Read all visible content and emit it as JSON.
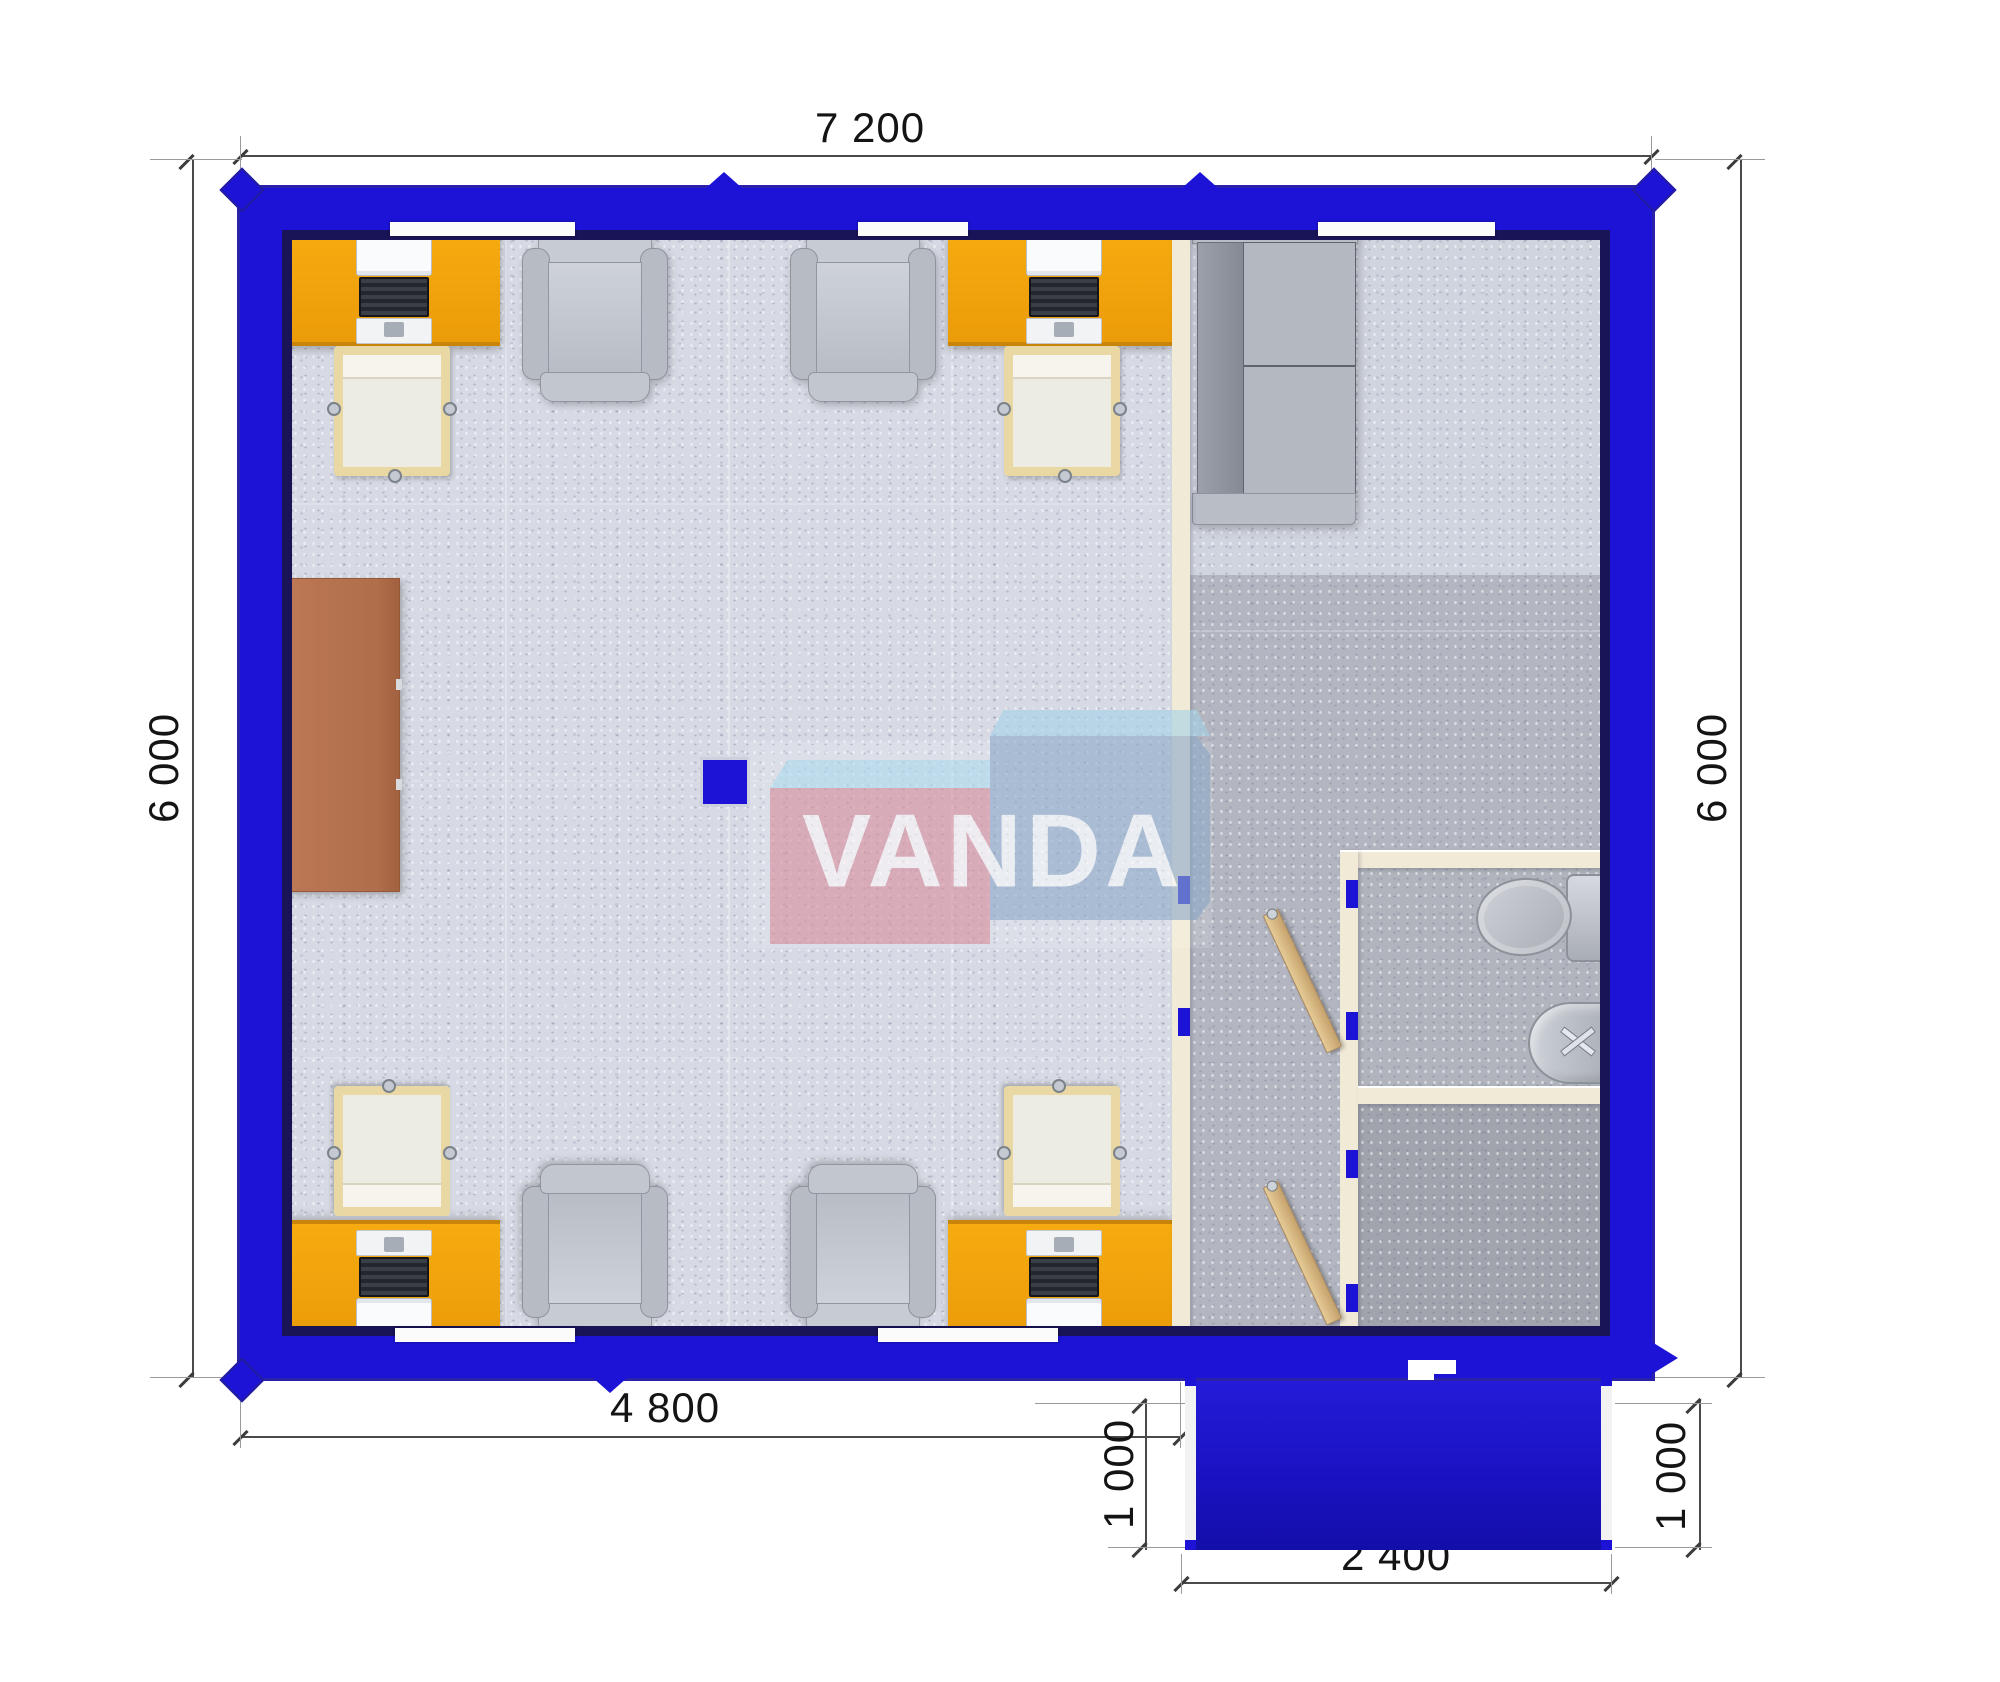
{
  "plan": {
    "watermark": {
      "brand": "VANDA"
    },
    "dimensions": {
      "top_width": "7 200",
      "left_height": "6 000",
      "right_height": "6 000",
      "bottom_left_width": "4 800",
      "porch_depth_left": "1 000",
      "porch_depth_right": "1 000",
      "porch_bottom_width": "2 400"
    },
    "colors": {
      "wall_blue": "#1c13d6",
      "wall_rim_navy": "#191357",
      "porch_blue": "#1a12c0",
      "desk_orange": "#f2a30e",
      "cabinet_brown": "#b7724e",
      "partition_cream": "#f1ead7",
      "floor_light": "#d7dae4",
      "floor_dark": "#b3b6c0",
      "logo_pink": "#d98f9e",
      "logo_blue": "#8eabc9",
      "logo_skyblue": "#aedcef"
    },
    "furniture_icons": {
      "office_desk": 4,
      "desk_chair": 4,
      "visitor_armchair": 4,
      "sofa_sectional": 1,
      "cabinet": 1,
      "toilet": 1,
      "sink": 1,
      "open_door_leaf": 2,
      "support_column": 1
    }
  }
}
